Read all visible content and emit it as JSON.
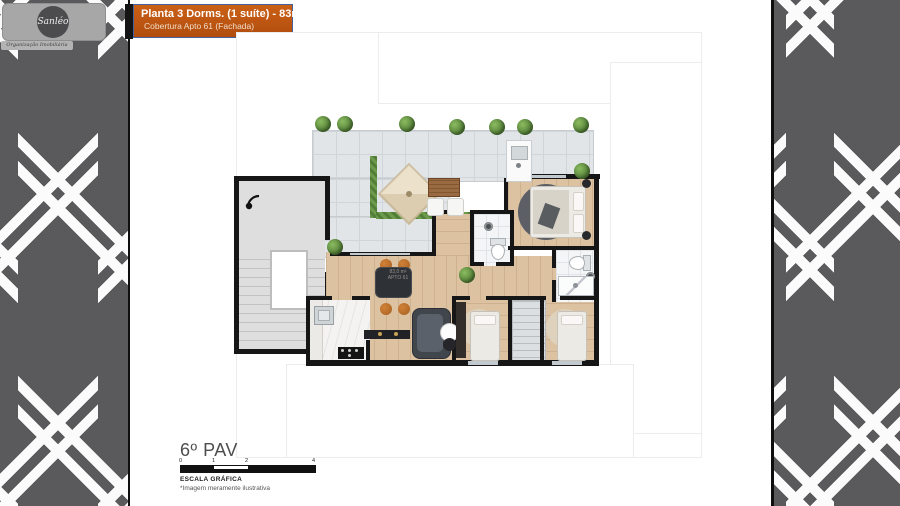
{
  "header": {
    "title": "Planta 3 Dorms. (1 suíte) - 83m²",
    "subtitle": "Cobertura Apto 61 (Fachada)",
    "accent_color": "#C2571B",
    "border_color": "#44609E"
  },
  "logo": {
    "brand": "Sanléo",
    "tagline": "Organização Imobiliária"
  },
  "plan": {
    "floor_label": "6º PAV",
    "unit_area": "83,0 m²",
    "unit_label": "APTO 61",
    "scale_title": "ESCALA GRÁFICA",
    "scale_note": "*Imagem meramente ilustrativa",
    "scale_ticks": [
      "0",
      "1",
      "2",
      "4"
    ]
  },
  "colors": {
    "panel": "#5A595C",
    "wall": "#161616",
    "wood_floor": "#DCC2A0",
    "terrace_tile": "#E1E5E8",
    "planter_green": "#6A9A4A",
    "chair_orange": "#C77B35"
  }
}
